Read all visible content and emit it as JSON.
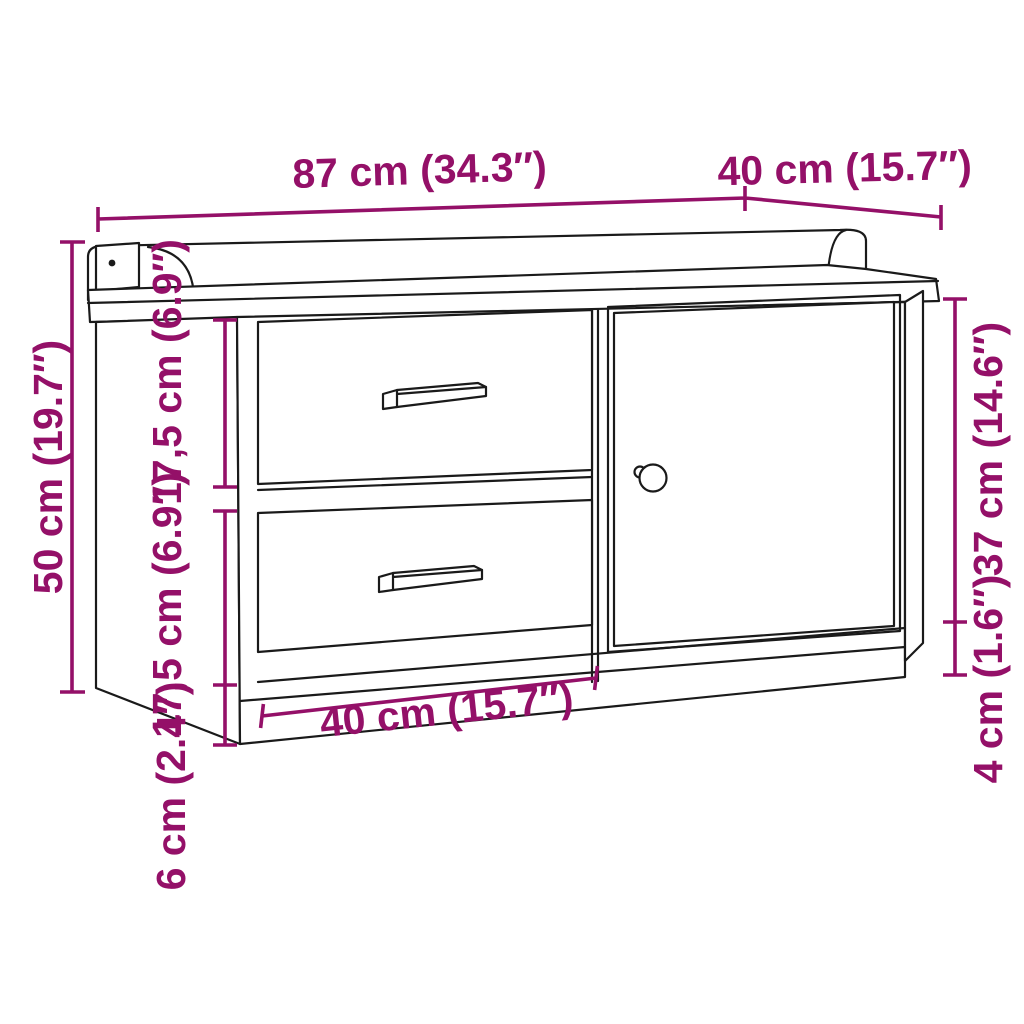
{
  "diagram": {
    "type": "furniture-dimension-drawing",
    "subject": "storage bench with two drawers and one door",
    "accent_color": "#941068",
    "line_color": "#1a1a1a",
    "labels": {
      "top_width": "87 cm (34.3″)",
      "top_depth": "40 cm (15.7″)",
      "overall_height": "50 cm (19.7″)",
      "drawer_top_height": "17,5 cm (6.9″)",
      "drawer_bottom_height": "17,5 cm (6.9″)",
      "plinth_height": "6 cm (2.4″)",
      "drawer_width": "40 cm (15.7″)",
      "door_height": "37 cm (14.6″)",
      "bottom_gap": "4 cm (1.6″)"
    }
  }
}
